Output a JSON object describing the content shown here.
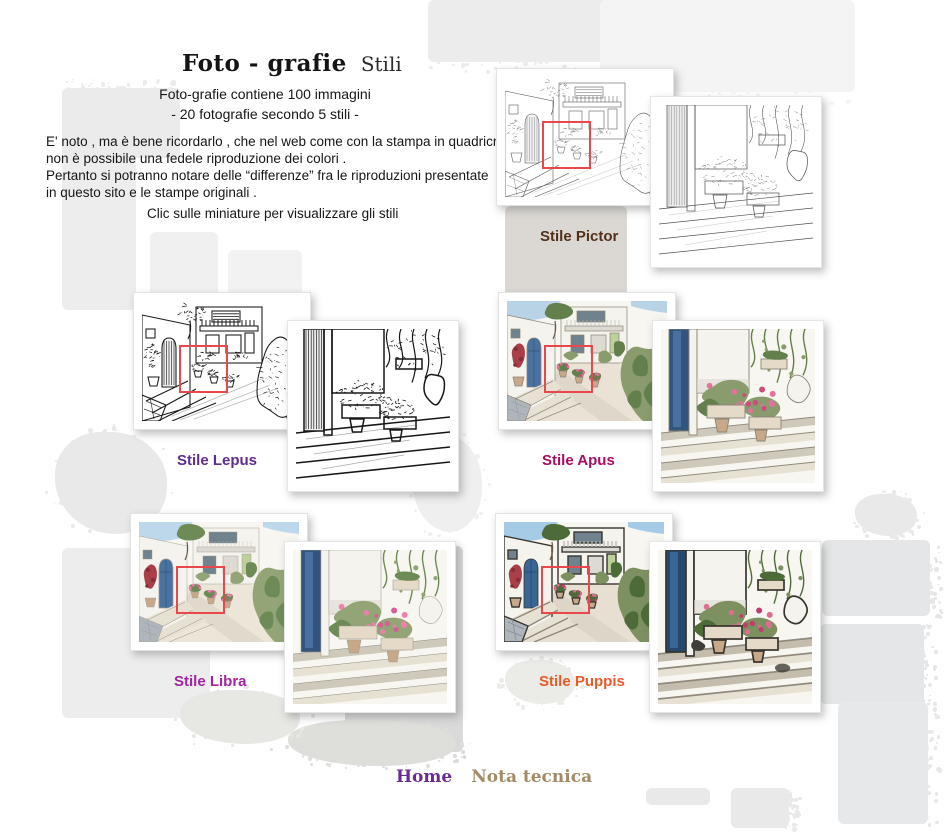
{
  "header": {
    "title_main": "Foto - grafie",
    "title_sub": "Stili"
  },
  "intro": {
    "line1": "Foto-grafie contiene 100 immagini",
    "line2": "- 20 fotografie secondo 5 stili -",
    "para1": "E' noto , ma è bene ricordarlo , che nel web come con la stampa in quadricromia",
    "para2": "non è possibile una fedele riproduzione dei colori .",
    "para3": "Pertanto si potranno notare delle “differenze” fra le riproduzioni presentate",
    "para4": "in questo sito e le stampe originali .",
    "cta": "Clic sulle miniature per visualizzare gli stili"
  },
  "styles": [
    {
      "id": "pictor",
      "label": "Stile Pictor",
      "label_color": "#53301b",
      "art": "pencil-sketch-fine"
    },
    {
      "id": "lepus",
      "label": "Stile Lepus",
      "label_color": "#5e2c92",
      "art": "ink-sketch-bold"
    },
    {
      "id": "apus",
      "label": "Stile Apus",
      "label_color": "#a90d63",
      "art": "watercolor-with-ink"
    },
    {
      "id": "libra",
      "label": "Stile Libra",
      "label_color": "#a224a0",
      "art": "soft-watercolor"
    },
    {
      "id": "puppis",
      "label": "Stile Puppis",
      "label_color": "#ea5a28",
      "art": "bold-cutout"
    }
  ],
  "marker": {
    "color": "#e8474b"
  },
  "footer": {
    "home_label": "Home",
    "home_color": "#6a2b92",
    "nota_label": "Nota tecnica",
    "nota_color": "#a58a66"
  }
}
